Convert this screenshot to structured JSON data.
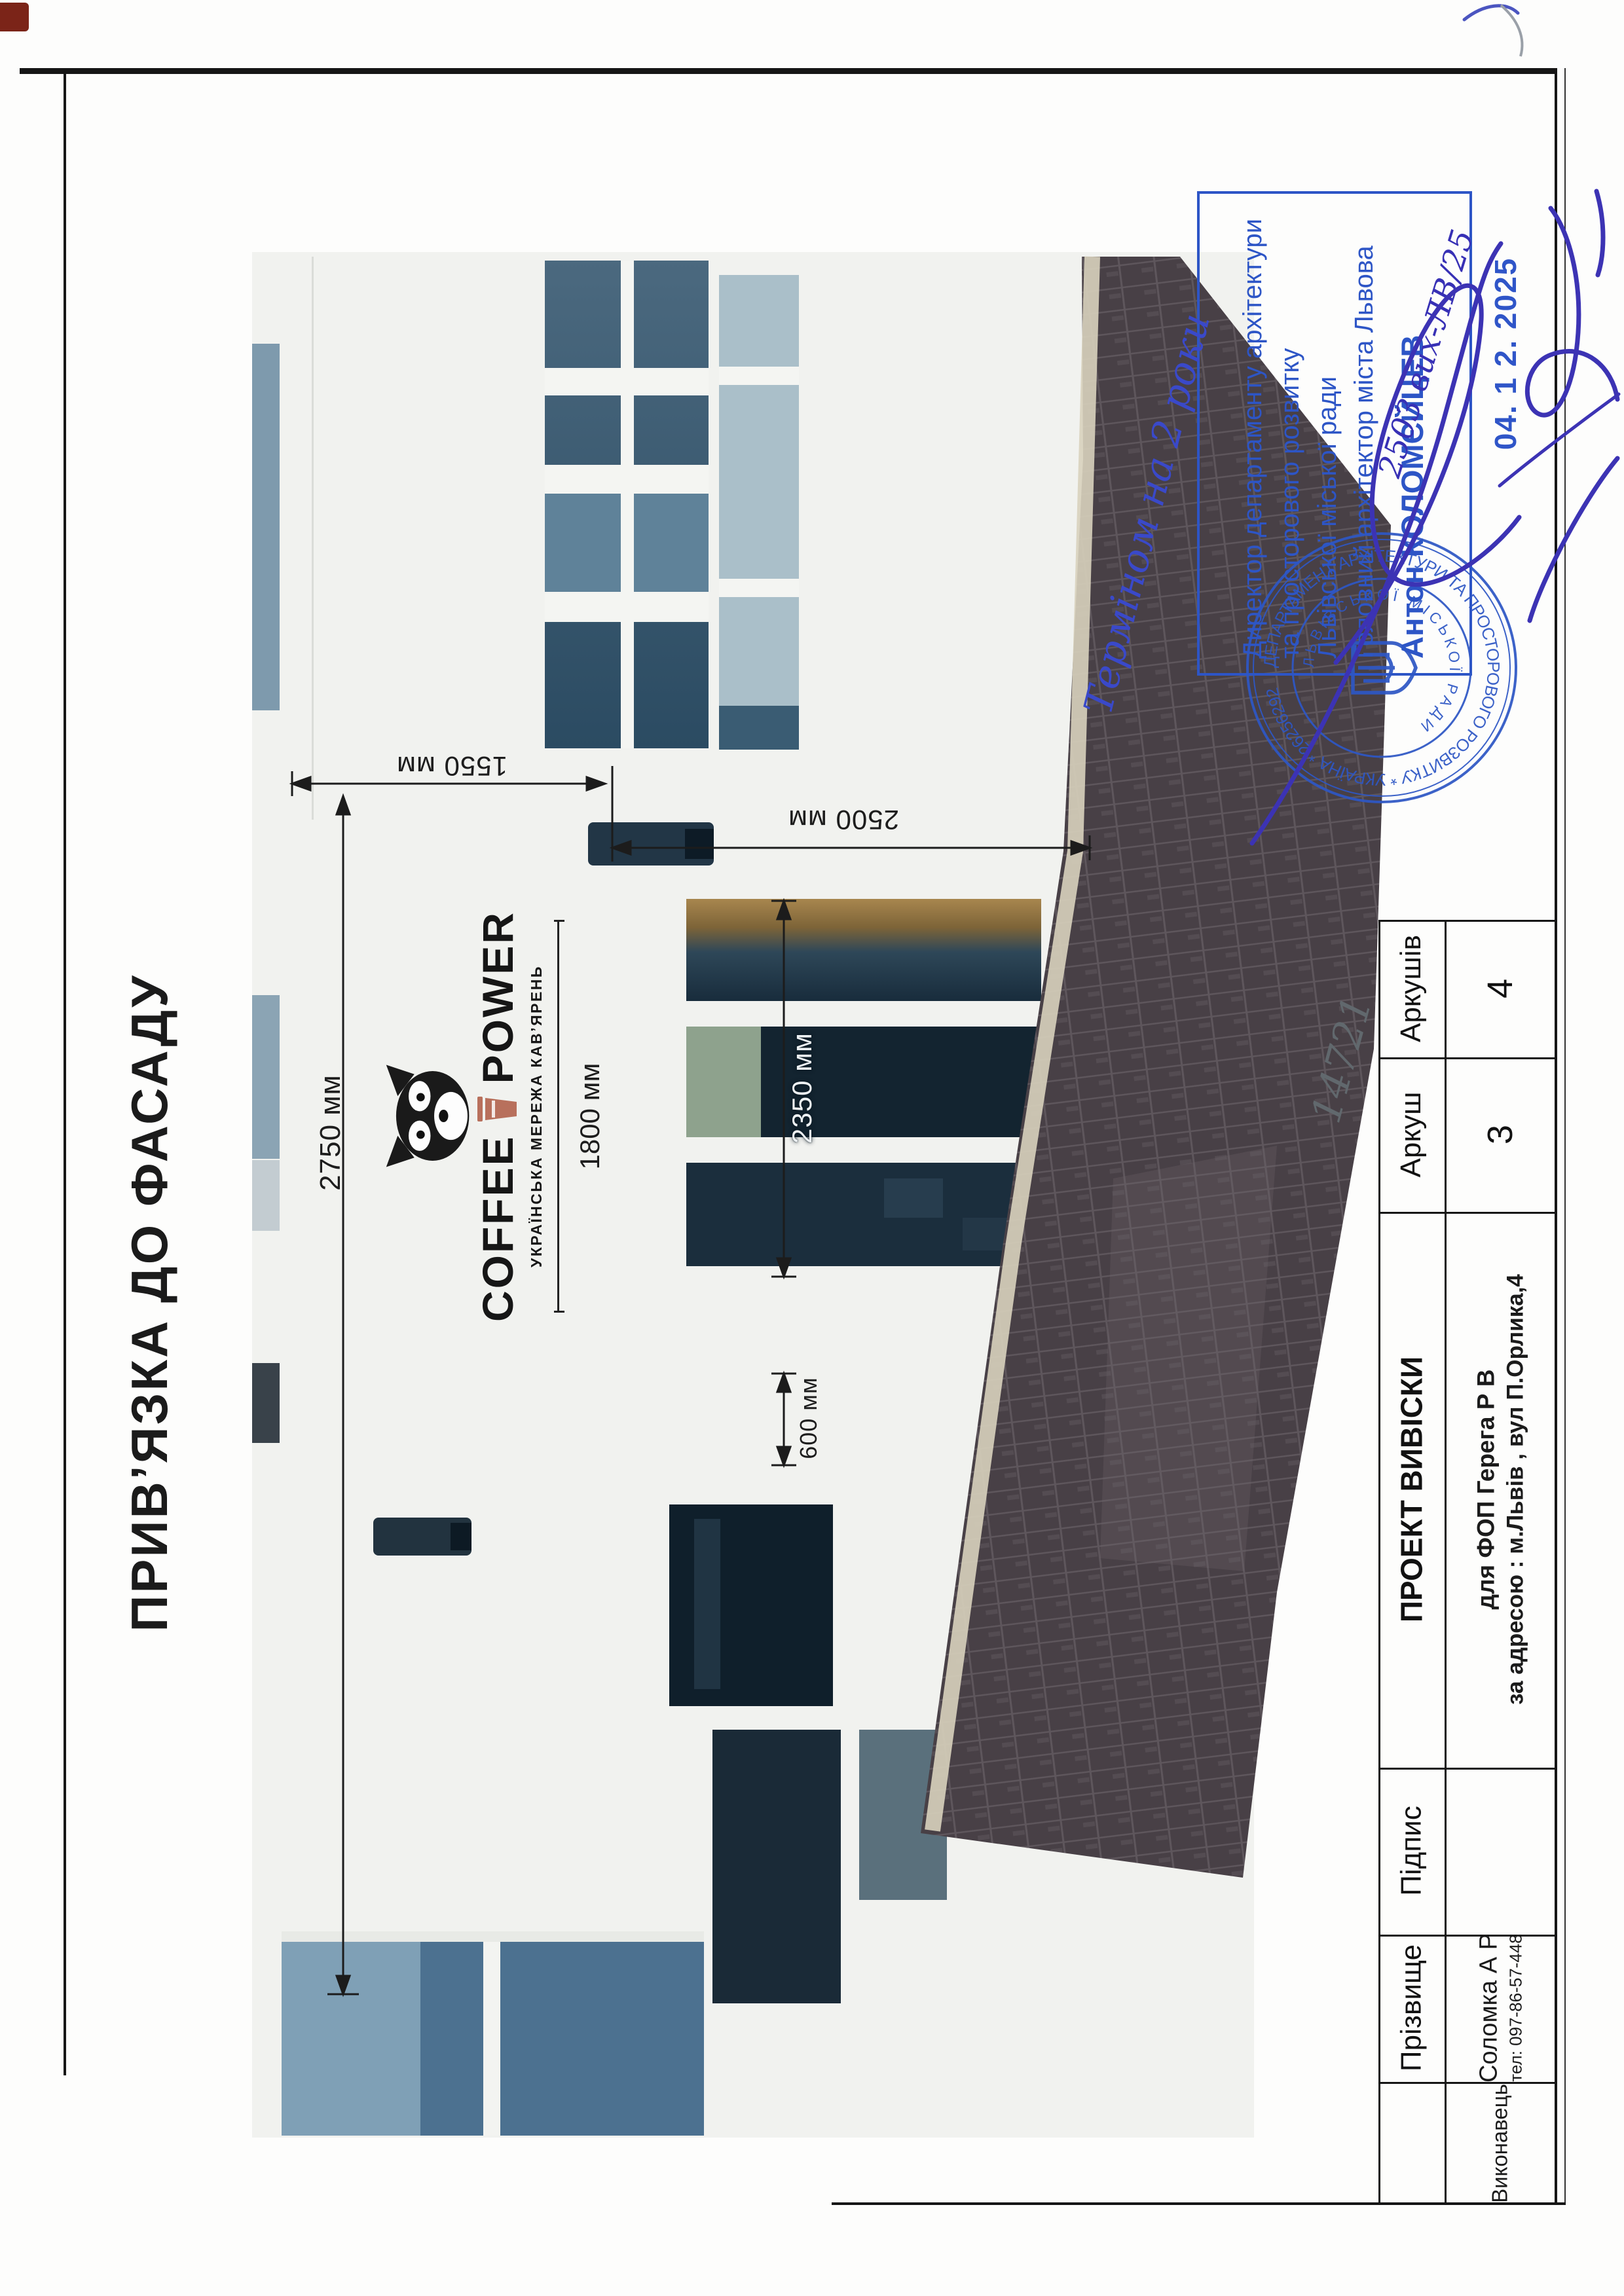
{
  "page": {
    "title": "ПРИВ’ЯЗКА ДО ФАСАДУ",
    "handwritten_number": "14721"
  },
  "facade_photo": {
    "dim_2750": "2750 мм",
    "dim_1550": "1550 мм",
    "dim_2500": "2500 мм",
    "dim_2350": "2350 мм",
    "dim_600": "600 мм",
    "sign_logo": {
      "word1": "COFFEE",
      "word2": "POWER",
      "tagline": "УКРАЇНСЬКА МЕРЕЖА КАВ’ЯРЕНЬ",
      "sign_width": "1800 мм",
      "mascot_icon": "raccoon-face",
      "cup_color": "#b8705c"
    }
  },
  "approval_stamp": {
    "term_note": "Терміном на 2 роки",
    "lines": [
      "Директор департаменту архітектури",
      "та просторового розвитку",
      "Львівської міської ради",
      "Головний архітектор міста Львова",
      "Антон КОЛОМЄЙЦЕВ"
    ],
    "ref_note": "2503 вих-ЛВ/25",
    "date_stamp": "04. 1 2. 2025",
    "ink_color": "#2d55c6",
    "seal": {
      "outer_text": "ДЕПАРТАМЕНТ АРХІТЕКТУРИ ТА ПРОСТОРОВОГО РОЗВИТКУ * УКРАЇНА * 26256292",
      "inner_text": "ЛЬВІВСЬКОЇ МІСЬКОЇ РАДИ"
    }
  },
  "title_block": {
    "headers": {
      "project": "ПРОЕКТ ВИВІСКИ",
      "pidpys": "Підпис",
      "prizvyshche": "Прізвище",
      "arkush": "Аркуш",
      "arkushiv": "Аркушів"
    },
    "values": {
      "arkush": "3",
      "arkushiv": "4",
      "client_line1": "для ФОП Герега Р В",
      "client_line2": "за адресою : м.Львів , вул П.Орлика,4",
      "executor_label": "Виконавець",
      "name": "Соломка А Р",
      "phone": "тел: 097-86-57-448"
    }
  }
}
